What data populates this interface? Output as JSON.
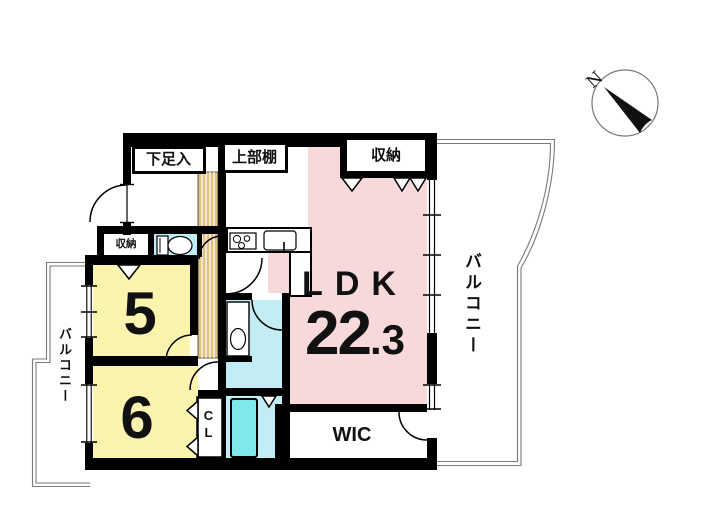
{
  "plan": {
    "entrance": {
      "shoe_cabinet_label": "下足入"
    },
    "kitchen": {
      "upper_shelf_label": "上部棚"
    },
    "ldk": {
      "name": "LDK",
      "area_int": "22",
      "area_frac": ".3"
    },
    "storage_top_label": "収納",
    "storage_hall_label": "収納",
    "bedroom_5_label": "5",
    "bedroom_6_label": "6",
    "wic_label": "WIC",
    "closet_label": "CL",
    "balcony_right_label": "バルコニー",
    "balcony_left_label": "バルコニー",
    "compass_north_label": "N"
  },
  "colors": {
    "wall": "#000000",
    "ldk_fill": "#f8d9d9",
    "bedroom_fill": "#faf4ae",
    "wet_fill": "#c2edf4",
    "tub_fill": "#7de9ec",
    "wood_fill": "#dfc180",
    "outline_line": "#7a7a7a"
  }
}
